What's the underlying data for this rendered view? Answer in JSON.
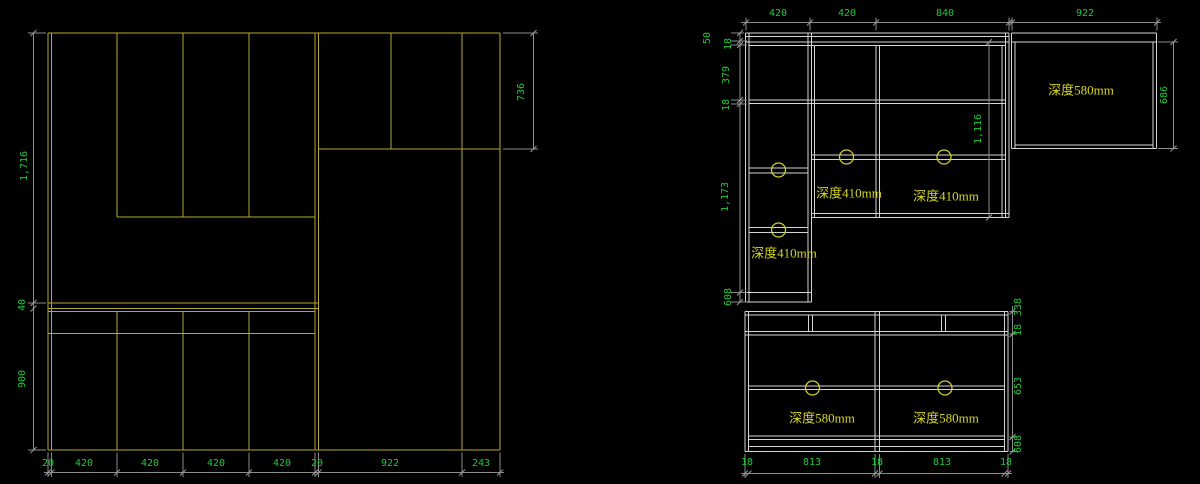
{
  "drawing_type": "cabinet elevation CAD drawing",
  "colors": {
    "background": "#000000",
    "left_view_linework": "#b5a82e",
    "right_view_linework": "#d4d4d4",
    "dimension_lines": "#8c8c8c",
    "dimension_text": "#1fc93a",
    "depth_text": "#d6d621",
    "knob_circles": "#cfcf2a"
  },
  "left_view": {
    "dims_left": [
      "1,716",
      "40",
      "900"
    ],
    "dim_right": "736",
    "dims_bottom": [
      "20",
      "420",
      "420",
      "420",
      "420",
      "20",
      "922",
      "243"
    ]
  },
  "right_view": {
    "dims_top": [
      "420",
      "420",
      "840",
      "922"
    ],
    "tall_cabinet": {
      "dims_left": [
        "50",
        "18",
        "379",
        "18",
        "1,173",
        "608"
      ],
      "dim_height_inner": "1,116",
      "depth_labels": [
        "深度410mm",
        "深度410mm",
        "深度410mm"
      ]
    },
    "wall_cabinet": {
      "depth_label": "深度580mm",
      "dim_right": "686"
    },
    "base_cabinet": {
      "depth_labels": [
        "深度580mm",
        "深度580mm"
      ],
      "dims_right": [
        "338",
        "18",
        "653",
        "608"
      ],
      "dims_bottom": [
        "18",
        "813",
        "18",
        "813",
        "18"
      ]
    }
  }
}
